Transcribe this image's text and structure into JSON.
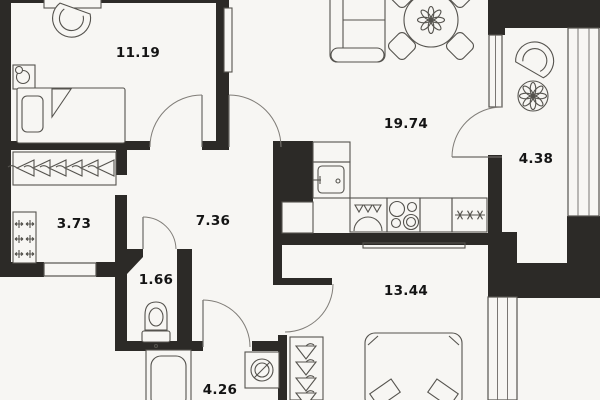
{
  "plan": {
    "title": "apartment floor plan",
    "colors": {
      "background": "#f7f6f3",
      "walls": "#2c2a27",
      "furniture_lines": "#55534e",
      "label_text": "#141414"
    },
    "rooms": [
      {
        "name": "bedroom-1",
        "area": "11.19"
      },
      {
        "name": "living-room-kitchen",
        "area": "19.74"
      },
      {
        "name": "balcony",
        "area": "4.38"
      },
      {
        "name": "dressing-room",
        "area": "3.73"
      },
      {
        "name": "hallway",
        "area": "7.36"
      },
      {
        "name": "wc",
        "area": "1.66"
      },
      {
        "name": "bedroom-2",
        "area": "13.44"
      },
      {
        "name": "bathroom",
        "area": "4.26"
      }
    ],
    "icons": [
      "bed-icon",
      "pillow-icon",
      "table-lamp-icon",
      "desk-icon",
      "desk-chair-icon",
      "hanger-icon",
      "shelf-plus-icon",
      "toilet-icon",
      "corner-shelf-icon",
      "bathtub-icon",
      "washing-machine-icon",
      "kitchen-sink-icon",
      "dishwasher-icon",
      "stove-icon",
      "fridge-asterisks-icon",
      "sofa-icon",
      "dining-table-icon",
      "dining-chair-icon",
      "flower-icon",
      "balcony-chair-icon",
      "balcony-table-icon",
      "door-swing-icon",
      "window-glazing-icon"
    ]
  }
}
